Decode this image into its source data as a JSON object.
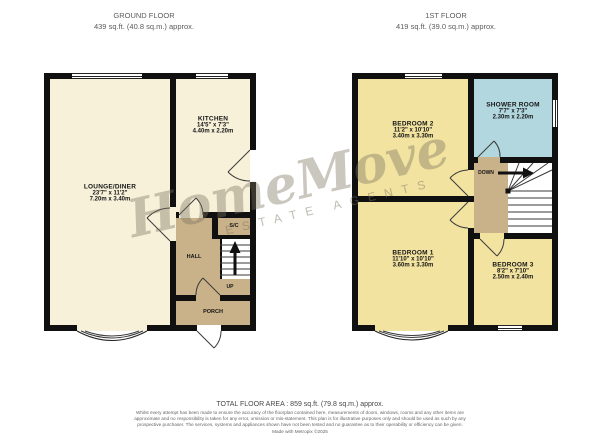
{
  "ground_floor": {
    "title": "GROUND FLOOR",
    "area": "439 sq.ft. (40.8 sq.m.) approx.",
    "rooms": {
      "lounge": {
        "name": "LOUNGE/DINER",
        "imperial": "23'7\" x 11'2\"",
        "metric": "7.20m x 3.40m"
      },
      "kitchen": {
        "name": "KITCHEN",
        "imperial": "14'5\" x 7'3\"",
        "metric": "4.40m x 2.20m"
      },
      "hall": {
        "name": "HALL"
      },
      "store": {
        "name": "S/C"
      },
      "porch": {
        "name": "PORCH"
      }
    },
    "stair_label": "UP"
  },
  "first_floor": {
    "title": "1ST FLOOR",
    "area": "419 sq.ft. (39.0 sq.m.) approx.",
    "rooms": {
      "bedroom2": {
        "name": "BEDROOM 2",
        "imperial": "11'2\" x 10'10\"",
        "metric": "3.40m x 3.30m"
      },
      "shower": {
        "name": "SHOWER ROOM",
        "imperial": "7'7\" x 7'3\"",
        "metric": "2.30m x 2.20m"
      },
      "bedroom1": {
        "name": "BEDROOM 1",
        "imperial": "11'10\" x 10'10\"",
        "metric": "3.60m x 3.30m"
      },
      "bedroom3": {
        "name": "BEDROOM 3",
        "imperial": "8'2\" x 7'10\"",
        "metric": "2.50m x 2.40m"
      }
    },
    "stair_label": "DOWN"
  },
  "watermark": {
    "title": "HomeMove",
    "subtitle": "ESTATE AGENTS"
  },
  "footer": {
    "total_area": "TOTAL FLOOR AREA : 859 sq.ft. (79.8 sq.m.) approx.",
    "disclaimer": "Whilst every attempt has been made to ensure the accuracy of the floorplan contained here, measurements of doors, windows, rooms and any other items are approximate and no responsibility is taken for any error, omission or mis-statement. This plan is for illustrative purposes only and should be used as such by any prospective purchaser. The services, systems and appliances shown have not been tested and no guarantee as to their operability or efficiency can be given.",
    "credit": "Made with Metropix ©2025"
  },
  "colors": {
    "wall": "#101010",
    "room_cream": "#f7f1da",
    "room_yellow": "#f2e3a1",
    "room_blue": "#b2d7de",
    "circulation_tan": "#c9b189",
    "watermark": "rgba(122,115,94,0.45)"
  }
}
